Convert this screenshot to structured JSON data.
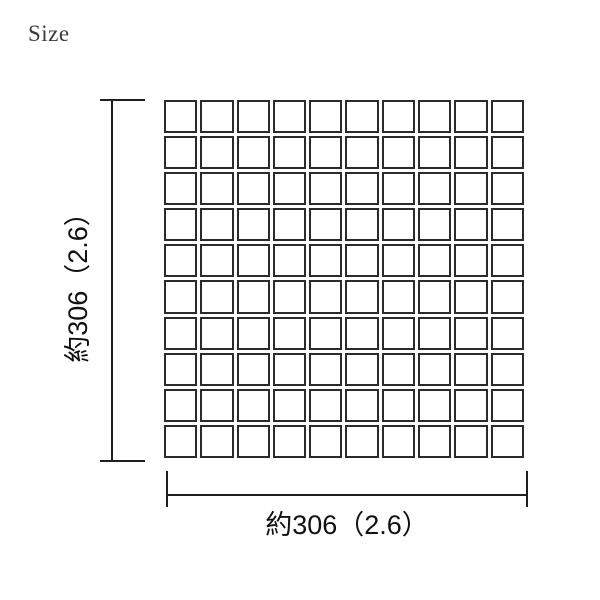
{
  "page": {
    "heading": "Size",
    "background_color": "#ffffff"
  },
  "diagram": {
    "type": "tile-sheet-size-diagram",
    "grid": {
      "rows": 10,
      "columns": 10,
      "tile_fill_color": "#ffffff",
      "tile_border_color": "#2b2b2b"
    },
    "dimension_lines": {
      "color": "#1f1f1f"
    },
    "labels": {
      "width": "約306（2.6）",
      "height": "約306（2.6）"
    }
  }
}
